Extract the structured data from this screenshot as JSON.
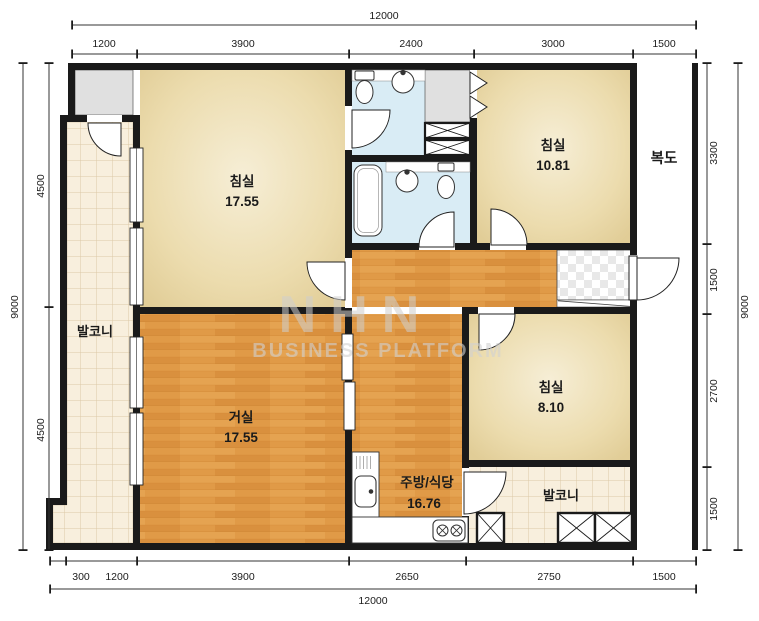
{
  "watermark": {
    "brand": "NHN",
    "subtitle": "BUSINESS PLATFORM"
  },
  "rooms": {
    "bedroom1": {
      "name": "침실",
      "area": "17.55"
    },
    "bedroom2": {
      "name": "침실",
      "area": "10.81"
    },
    "bedroom3": {
      "name": "침실",
      "area": "8.10"
    },
    "living": {
      "name": "거실",
      "area": "17.55"
    },
    "kitchen": {
      "name": "주방/식당",
      "area": "16.76"
    },
    "balcony_left": {
      "name": "발코니"
    },
    "balcony_right": {
      "name": "발코니"
    },
    "corridor": {
      "name": "복도"
    }
  },
  "dims": {
    "top_total": "12000",
    "top": [
      "1200",
      "3900",
      "2400",
      "3000",
      "1500"
    ],
    "bottom": [
      "300",
      "1200",
      "3900",
      "2650",
      "2750",
      "1500"
    ],
    "bottom_total": "12000",
    "left": [
      "4500",
      "4500"
    ],
    "left_total": "9000",
    "right": [
      "3300",
      "1500",
      "2700",
      "1500"
    ],
    "right_total": "9000"
  },
  "palette": {
    "wall": "#1a1a1a",
    "bedroom_floor": "#ecdcae",
    "wood_floor": "#e09a47",
    "bathroom_floor": "#d9ecf5",
    "balcony_tile": "#f8efdd",
    "utility_gray": "#e0e0e0",
    "watermark_gray": "#cfcfcf"
  }
}
